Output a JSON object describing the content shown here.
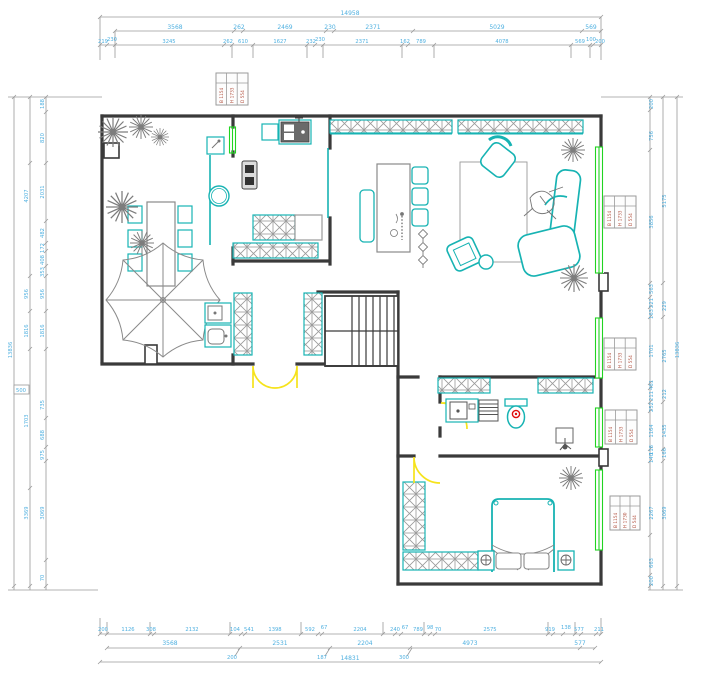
{
  "title": "floor-plan-drawing",
  "colors": {
    "wall": "#3a3a3a",
    "furniture_teal": "#17b3b3",
    "window_green": "#21d421",
    "door_yellow": "#f6e31c",
    "plant_gray": "#7d7d7d",
    "dim_text_blue": "#4fb0e0",
    "dim_line_gray": "#9a9a9a",
    "tag_red": "#b2503e"
  },
  "dims": {
    "top": {
      "overall": "14958",
      "row2": [
        "3568",
        "262",
        "2469",
        "230",
        "2371",
        "5029",
        "569"
      ],
      "row3": [
        "219",
        "230",
        "3245",
        "262",
        "610",
        "1627",
        "232",
        "230",
        "2371",
        "162",
        "789",
        "4078",
        "569",
        "100",
        "200"
      ]
    },
    "bottom": {
      "row1": [
        "200",
        "1126",
        "308",
        "2132",
        "104",
        "541",
        "1398",
        "592",
        "67",
        "2204",
        "240",
        "67",
        "789",
        "98",
        "70",
        "2575",
        "919",
        "138",
        "577",
        "211"
      ],
      "row2": [
        "3568",
        "2531",
        "2204",
        "4973",
        "577"
      ],
      "leaders": [
        "200",
        "187",
        "300"
      ],
      "overall": "14831"
    },
    "left": {
      "overall": "13836",
      "outer": [
        "4207",
        "956",
        "1816",
        "1703",
        "3369"
      ],
      "inner": [
        "188",
        "820",
        "2031",
        "482",
        "172",
        "408",
        "353",
        "956",
        "1816",
        "735",
        "688",
        "975",
        "3069",
        "70"
      ],
      "leader": "500"
    },
    "right": {
      "overall": "13836",
      "outer": [
        "5175",
        "229",
        "2765",
        "212",
        "1435",
        "166",
        "3069"
      ],
      "inner": [
        "200",
        "756",
        "3856",
        "563",
        "221",
        "163",
        "1701",
        "461",
        "211",
        "252",
        "1164",
        "118",
        "140",
        "2267",
        "663",
        "200"
      ]
    }
  },
  "window_tags": [
    {
      "c1": "B 1154",
      "c2": "H 1733",
      "c3": "D 554"
    },
    {
      "c1": "B 1154",
      "c2": "H 1733",
      "c3": "D 554"
    },
    {
      "c1": "B 1154",
      "c2": "H 1733",
      "c3": "D 554"
    },
    {
      "c1": "B 1154",
      "c2": "H 1733",
      "c3": "D 554"
    },
    {
      "c1": "B 1154",
      "c2": "H 1730",
      "c3": "D 544"
    }
  ]
}
